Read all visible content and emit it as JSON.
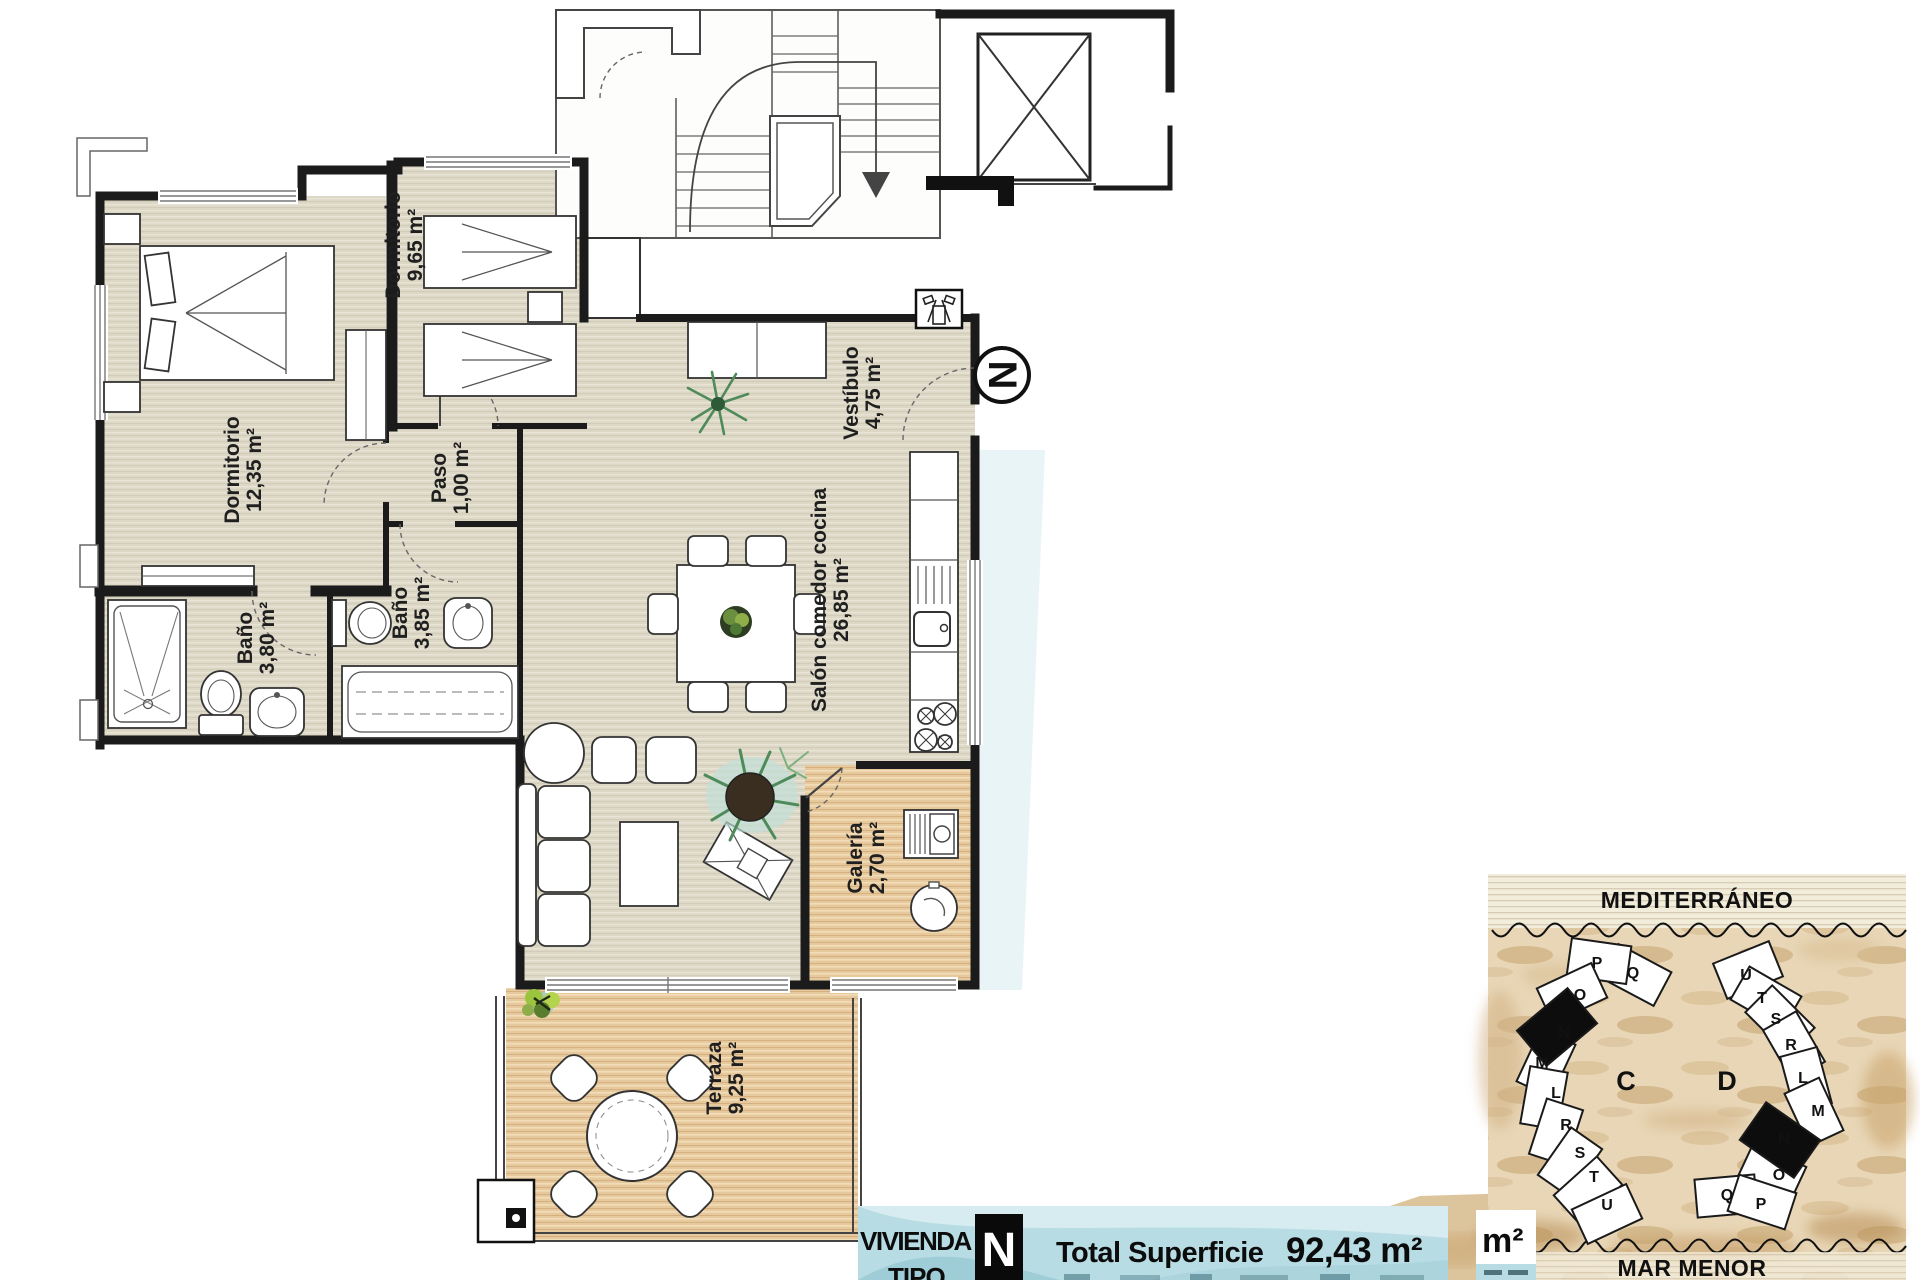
{
  "floor_plan": {
    "rooms": [
      {
        "name": "Dormitorio",
        "area": "12,35 m²"
      },
      {
        "name": "Dormitorio",
        "area": "9,65 m²"
      },
      {
        "name": "Paso",
        "area": "1,00 m²"
      },
      {
        "name": "Baño",
        "area": "3,80 m²"
      },
      {
        "name": "Baño",
        "area": "3,85 m²"
      },
      {
        "name": "Vestíbulo",
        "area": "4,75 m²"
      },
      {
        "name": "Salón comedor cocina",
        "area": "26,85 m²"
      },
      {
        "name": "Galería",
        "area": "2,70 m²"
      },
      {
        "name": "Terraza",
        "area": "9,25 m²"
      }
    ],
    "north_label": "N"
  },
  "banner": {
    "property_word1": "VIVIENDA",
    "property_word2": "TIPO",
    "type_letter": "N",
    "total_label": "Total Superficie",
    "total_value": "92,43 m²",
    "corner_unit": "m²"
  },
  "site_plan": {
    "sea_top": "MEDITERRÁNEO",
    "sea_bottom": "MAR MENOR",
    "building_c_label": "C",
    "building_d_label": "D",
    "building_c_units": [
      "P",
      "Q",
      "O",
      "N",
      "M",
      "L",
      "R",
      "S",
      "T",
      "U"
    ],
    "building_d_units": [
      "U",
      "T",
      "S",
      "R",
      "L",
      "M",
      "N",
      "O",
      "Q",
      "P"
    ]
  },
  "colors": {
    "floor": "#ddd8c6",
    "wood": "#e7c99e",
    "wall": "#1b1b1b",
    "banner_bg": "#b7dce4",
    "sand": "#e8d6b6",
    "plant_green": "#4f8b5a"
  }
}
